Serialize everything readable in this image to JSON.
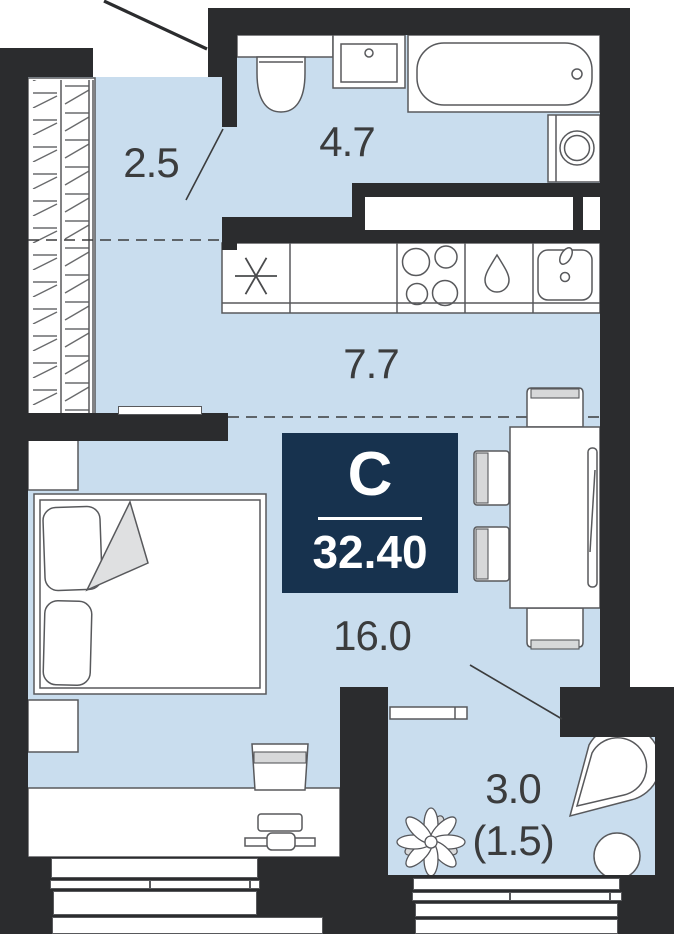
{
  "plan": {
    "title": "studio-floor-plan",
    "badge": {
      "type_label": "С",
      "total_area": "32.40"
    },
    "rooms": [
      {
        "id": "hallway",
        "area": "2.5"
      },
      {
        "id": "bathroom",
        "area": "4.7"
      },
      {
        "id": "kitchen",
        "area": "7.7"
      },
      {
        "id": "living-room",
        "area": "16.0"
      },
      {
        "id": "balcony",
        "area": "3.0",
        "area_reduced": "(1.5)"
      }
    ]
  },
  "colors": {
    "bg": "#ffffff",
    "wall": "#2b2c2e",
    "floor": "#c9ddee",
    "badge_bg": "#17324e",
    "outline": "#58595c",
    "outline_light": "#6a6b6d",
    "fill_gray": "#d7d8d9",
    "text": "#3b3c3d"
  },
  "icons": {
    "fridge-snowflake-icon": "asterisk",
    "stove-burners-icon": "four-circles",
    "dishwasher-drop-icon": "water-drop",
    "kitchen-sink-icon": "basin-with-faucet",
    "washing-machine-icon": "square-with-drum-circle",
    "plant-icon": "flower-top-view"
  }
}
